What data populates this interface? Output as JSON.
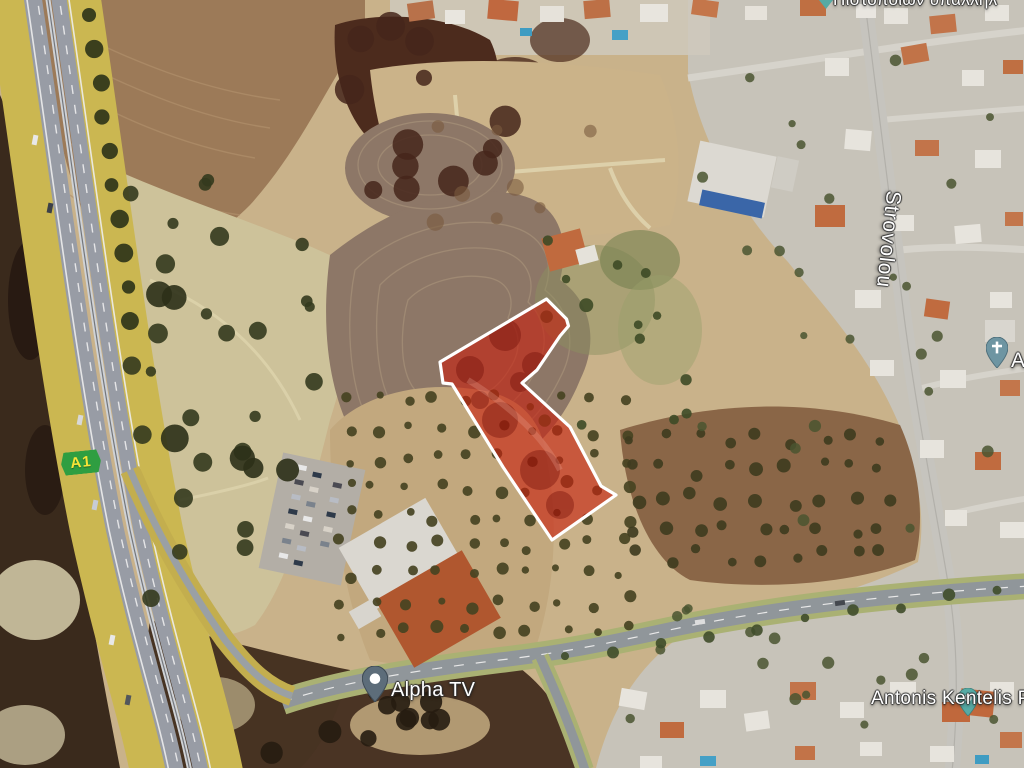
{
  "map": {
    "labels": {
      "alpha_tv": "Alpha TV",
      "strovolou": "Strovolou",
      "antonis": "Antonis Kentelis P",
      "top_partial": "Πιστοποιών υπαλλήλ",
      "church_partial": "A",
      "route_a1": "A1"
    },
    "colors": {
      "parcel_fill": "#c8200f",
      "parcel_stroke": "#ffffff",
      "badge_bg": "#2f9e41",
      "badge_text": "#f7e437",
      "alpha_pin": "#5d6d7a",
      "church_pin": "#6e95a2",
      "teal_pin": "#56aaa4"
    }
  }
}
